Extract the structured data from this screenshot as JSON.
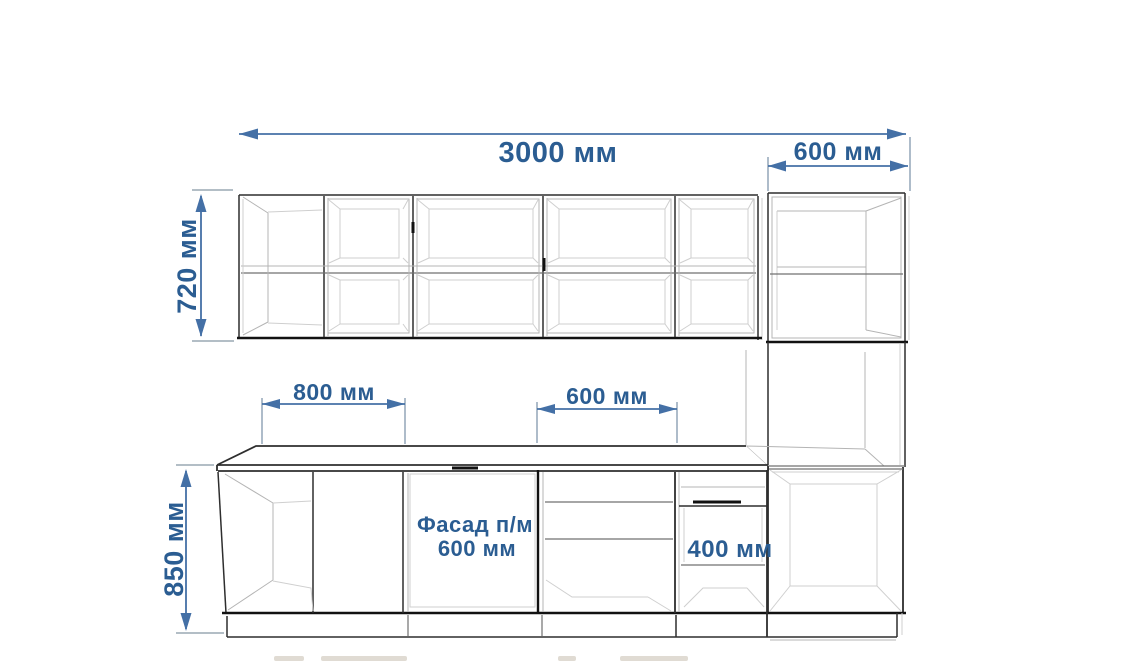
{
  "drawing": {
    "unit": "мм",
    "dim_total_width": {
      "value": 3000,
      "label": "3000 мм"
    },
    "dim_column_width": {
      "value": 600,
      "label": "600 мм"
    },
    "dim_wall_height": {
      "value": 720,
      "label": "720 мм"
    },
    "dim_base_height": {
      "value": 850,
      "label": "850 мм"
    },
    "dim_base_left_width": {
      "value": 800,
      "label": "800 мм"
    },
    "dim_base_mid_width": {
      "value": 600,
      "label": "600 мм"
    },
    "dim_niche_height": {
      "value": 400,
      "label": "400 мм"
    },
    "facade_note": {
      "line1": "Фасад п/м",
      "line2": "600 мм"
    }
  },
  "colors": {
    "dimension_text": "#2b5d92",
    "dimension_line": "#4470a6",
    "extension_line": "#93a5b8",
    "outline_dark": "#2e2e2e",
    "outline_heavy": "#121212",
    "interior_light": "#b4b4b4",
    "background": "#ffffff"
  }
}
